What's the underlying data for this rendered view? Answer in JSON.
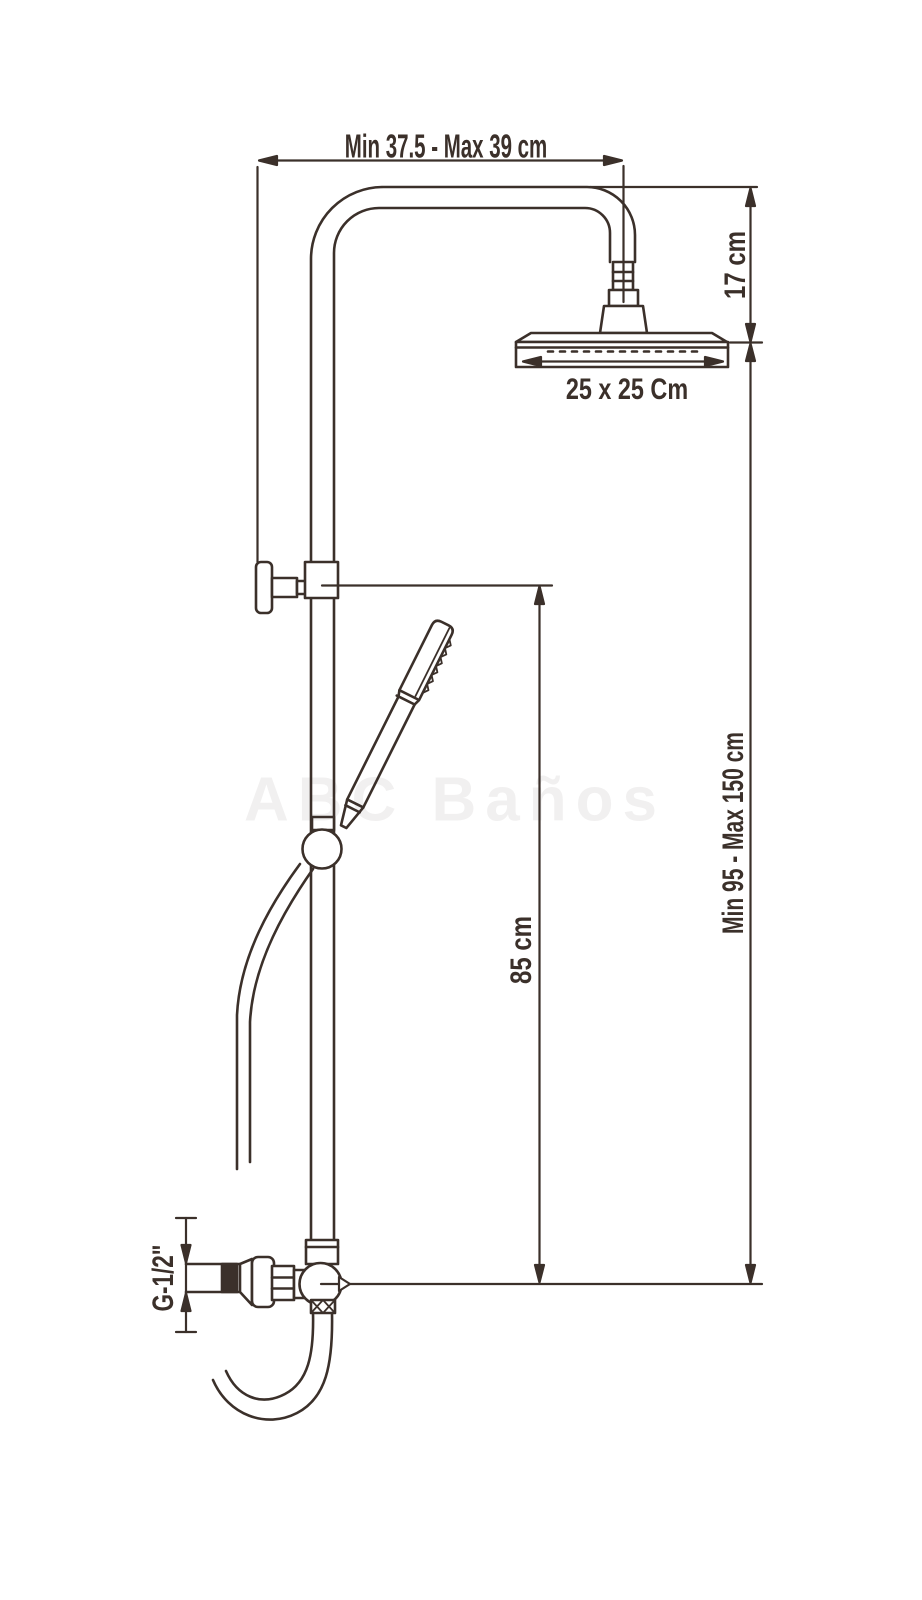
{
  "diagram": {
    "type": "technical-drawing",
    "subject": "shower-column-with-overhead-and-hand-shower",
    "line_color": "#3b302a",
    "background": "#ffffff",
    "watermark": "ABC Baños",
    "dimensions": {
      "arm_reach": "Min 37.5 - Max 39 cm",
      "head_drop": "17 cm",
      "head_size": "25 x 25 Cm",
      "handset_outlet_height": "85 cm",
      "column_height": "Min 95 - Max 150 cm",
      "inlet_thread": "G-1/2\""
    }
  }
}
